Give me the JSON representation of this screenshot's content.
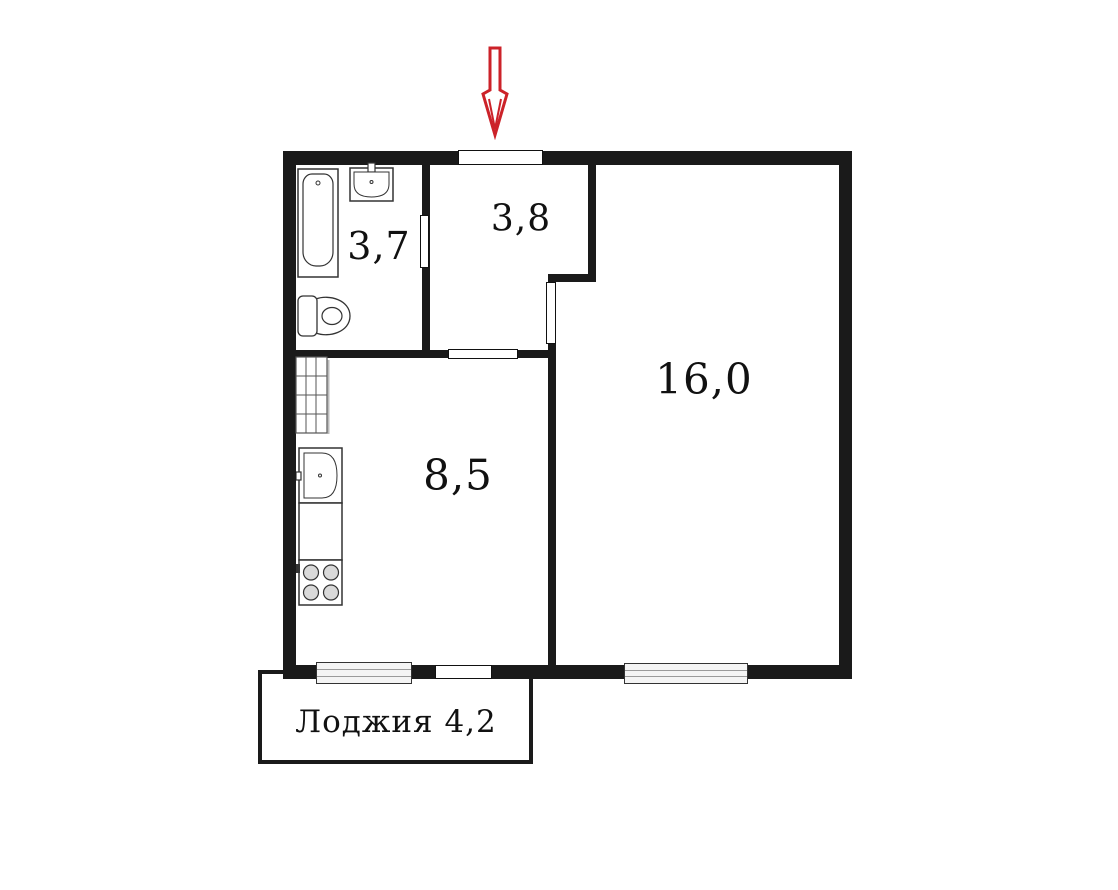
{
  "plan": {
    "type": "apartment-floor-plan",
    "rooms": {
      "bathroom": {
        "area": "3,7"
      },
      "hallway": {
        "area": "3,8"
      },
      "living": {
        "area": "16,0"
      },
      "kitchen": {
        "area": "8,5"
      },
      "loggia": {
        "label": "Лоджия 4,2"
      }
    },
    "fixtures": {
      "bathroom": [
        "bathtub",
        "wash-basin",
        "toilet"
      ],
      "kitchen": [
        "ventilation-shaft",
        "kitchen-sink",
        "worktop",
        "stove-4-burners"
      ]
    },
    "markers": {
      "entrance_arrow": "red-arrow-pointing-down-at-entrance-door"
    },
    "openings": {
      "entrance_door": "top-wall",
      "bathroom_door": "bathroom-hallway-wall",
      "kitchen_door": "hallway-kitchen-wall",
      "living_door": "hallway-living-wall",
      "loggia_door": "kitchen-loggia-wall",
      "windows": [
        "kitchen-loggia-window",
        "living-room-window"
      ]
    },
    "colors": {
      "wall": "#1a1a1a",
      "arrow_red": "#cc2229",
      "window_fill": "#f4f4f4",
      "background": "#ffffff"
    }
  }
}
